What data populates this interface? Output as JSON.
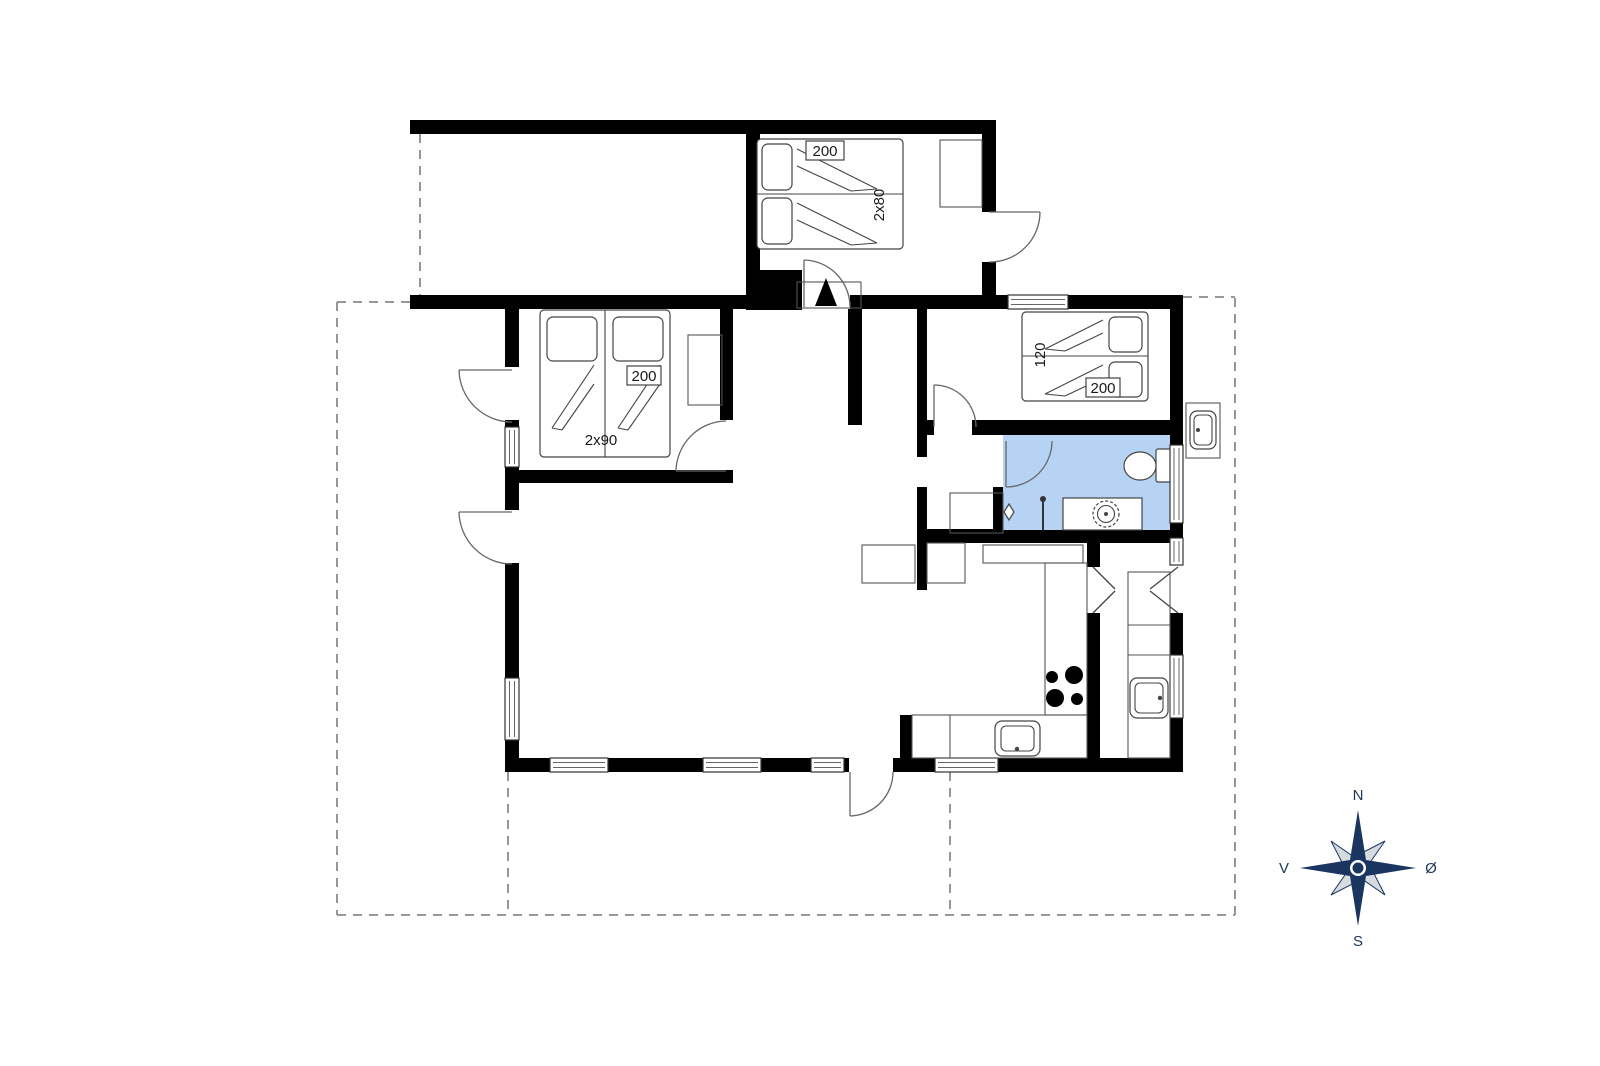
{
  "floor_plan": {
    "bedroom_top": {
      "length_label": "200",
      "width_label": "2x80"
    },
    "bedroom_left": {
      "length_label": "200",
      "width_label": "2x90"
    },
    "bedroom_right": {
      "width_label": "120",
      "length_label": "200"
    },
    "compass": {
      "north": "N",
      "south": "S",
      "west": "V",
      "east": "Ø"
    },
    "colors": {
      "wall": "#000000",
      "bathroom_fill": "#b7d3f3",
      "compass_primary": "#1a3560",
      "compass_secondary": "#d7dbe0",
      "dashed_line": "#8a8a8a"
    }
  }
}
